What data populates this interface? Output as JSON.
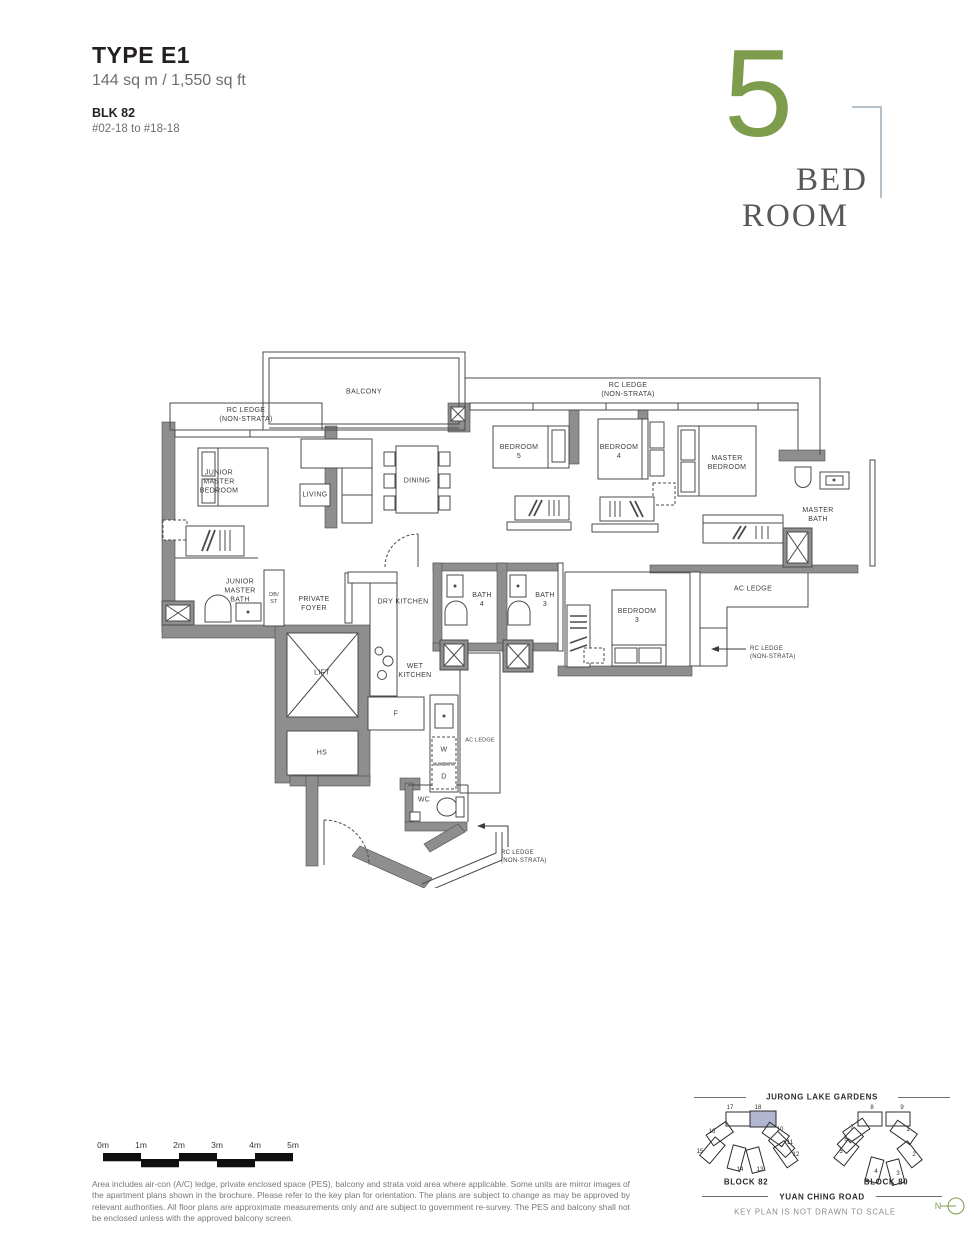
{
  "header": {
    "type": "TYPE E1",
    "area": "144 sq m / 1,550 sq ft",
    "block": "BLK 82",
    "units": "#02-18 to #18-18"
  },
  "logo": {
    "number": "5",
    "word_top": "BED",
    "word_bottom": "ROOM"
  },
  "plan": {
    "labels": {
      "balcony": "BALCONY",
      "rc_ledge_top_left": "RC LEDGE\n(NON-STRATA)",
      "rc_ledge_top_right": "RC LEDGE\n(NON-STRATA)",
      "junior_master_bedroom": "JUNIOR\nMASTER\nBEDROOM",
      "living": "LIVING",
      "dining": "DINING",
      "bedroom_5": "BEDROOM\n5",
      "bedroom_4": "BEDROOM\n4",
      "master_bedroom": "MASTER\nBEDROOM",
      "master_bath": "MASTER\nBATH",
      "junior_master_bath": "JUNIOR\nMASTER\nBATH",
      "db_st": "DB/\nST",
      "private_foyer": "PRIVATE\nFOYER",
      "dry_kitchen": "DRY KITCHEN",
      "bath_4": "BATH\n4",
      "bath_3": "BATH\n3",
      "bedroom_3": "BEDROOM\n3",
      "ac_ledge_right": "AC LEDGE",
      "rc_ledge_mid_right": "RC LEDGE\n(NON-STRATA)",
      "lift": "LIFT",
      "wet_kitchen": "WET\nKITCHEN",
      "fridge": "F",
      "hs": "HS",
      "washer": "W",
      "dryer": "D",
      "ac_ledge_bottom": "AC LEDGE",
      "wc": "WC",
      "rc_ledge_bottom": "RC LEDGE\n(NON-STRATA)"
    }
  },
  "scalebar": {
    "labels": [
      "0m",
      "1m",
      "2m",
      "3m",
      "4m",
      "5m"
    ]
  },
  "disclaimer": "Area includes air-con (A/C) ledge, private enclosed space (PES), balcony and strata void area where applicable. Some units are mirror images of the apartment plans shown in the brochure. Please refer to the key plan for orientation. The plans are subject to change as may be approved by relevant authorities. All floor plans are approximate measurements only and are subject to government re-survey. The PES and balcony shall not be enclosed unless with the approved balcony screen.",
  "keyplan": {
    "top_label": "JURONG LAKE GARDENS",
    "bottom_label": "YUAN CHING ROAD",
    "note": "KEY PLAN IS NOT DRAWN TO SCALE",
    "north": "N",
    "highlighted_unit": "18",
    "block_left": {
      "name": "BLOCK 82",
      "units": [
        "17",
        "18",
        "16",
        "10",
        "11",
        "12",
        "15",
        "14",
        "13"
      ]
    },
    "block_right": {
      "name": "BLOCK 80",
      "units": [
        "8",
        "9",
        "7",
        "6",
        "5",
        "1",
        "2",
        "4",
        "3"
      ]
    }
  },
  "colors": {
    "accent_green": "#7e9d4c",
    "highlight": "#b2b6d0",
    "wall": "#8e8e8e"
  }
}
